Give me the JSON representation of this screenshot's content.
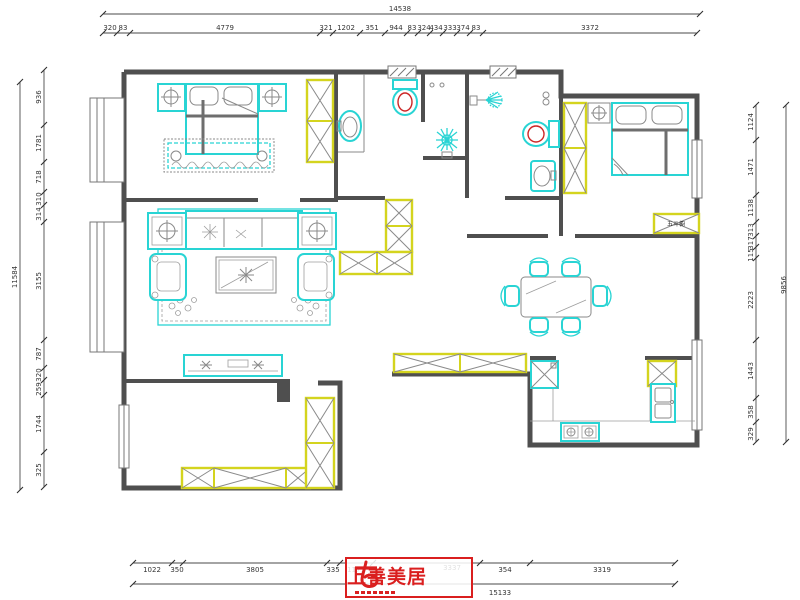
{
  "logo": {
    "text": "上善美居",
    "color": "#da1f1f"
  },
  "labels": {
    "chest": "五斗橱"
  },
  "dimensions": {
    "top": {
      "total": "14538",
      "segments": [
        "320",
        "83",
        "4779",
        "321",
        "1202",
        "351",
        "944",
        "83",
        "324",
        "434",
        "333",
        "374",
        "83",
        "3372"
      ]
    },
    "left": {
      "total": "11584",
      "segments": [
        "936",
        "1781",
        "718",
        "310",
        "314",
        "3155",
        "787",
        "320",
        "259",
        "1744",
        "325"
      ]
    },
    "right": {
      "total": "9856",
      "segments": [
        "1124",
        "1471",
        "1138",
        "313",
        "317",
        "115",
        "2223",
        "1443",
        "358",
        "329"
      ]
    },
    "bottom": {
      "total": "15133",
      "segments": [
        "1022",
        "350",
        "3805",
        "335",
        "1171",
        "3337",
        "354",
        "3319"
      ]
    }
  },
  "colors": {
    "wall": "#4f4f4f",
    "furniture_cyan": "#29d4d4",
    "cabinet_yellow": "#d4d41e",
    "accent_red": "#da1f1f",
    "dimension_text": "#333333"
  }
}
